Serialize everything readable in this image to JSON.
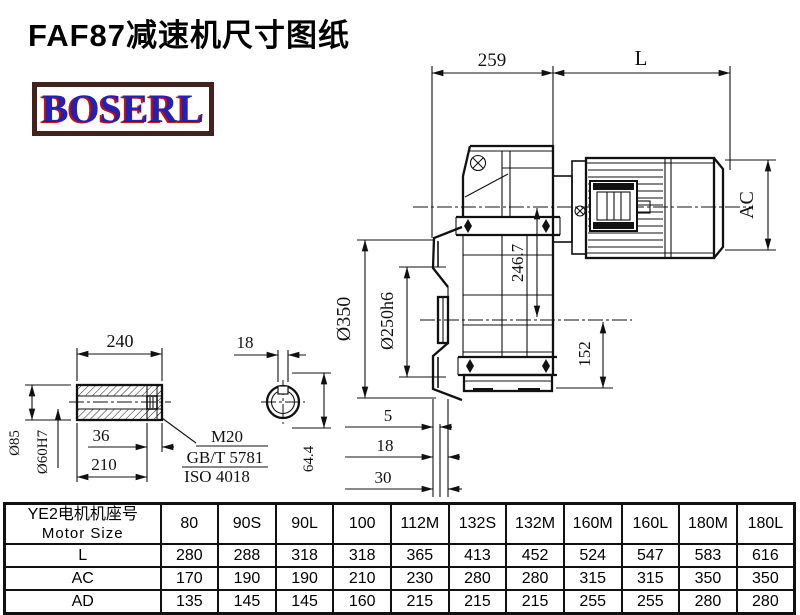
{
  "page": {
    "title": "FAF87减速机尺寸图纸",
    "logo": "BOSERL"
  },
  "drawing": {
    "dims": {
      "gearbox_length": "259",
      "motor_length": "L",
      "motor_diameter": "AC",
      "flange_od": "Ø350",
      "flange_spigot": "Ø250h6",
      "axis_height": "246.7",
      "lower_height": "152",
      "step1": "5",
      "step2": "18",
      "step3": "30"
    },
    "shaft": {
      "length": "240",
      "key_length": "36",
      "fit_length": "210",
      "outer_dia": "Ø85",
      "bore_dia": "Ø60H7",
      "key_width": "18",
      "key_height": "64.4",
      "callout_line1": "M20",
      "callout_line2": "GB/T 5781",
      "callout_line3": "ISO 4018"
    }
  },
  "table": {
    "header_cn": "YE2电机机座号",
    "header_en": "Motor Size",
    "sizes": [
      "80",
      "90S",
      "90L",
      "100",
      "112M",
      "132S",
      "132M",
      "160M",
      "160L",
      "180M",
      "180L"
    ],
    "rows": [
      {
        "label": "L",
        "values": [
          "280",
          "288",
          "318",
          "318",
          "365",
          "413",
          "452",
          "524",
          "547",
          "583",
          "616"
        ]
      },
      {
        "label": "AC",
        "values": [
          "170",
          "190",
          "190",
          "210",
          "230",
          "280",
          "280",
          "315",
          "315",
          "350",
          "350"
        ]
      },
      {
        "label": "AD",
        "values": [
          "135",
          "145",
          "145",
          "160",
          "215",
          "215",
          "215",
          "255",
          "255",
          "280",
          "280"
        ]
      }
    ]
  }
}
